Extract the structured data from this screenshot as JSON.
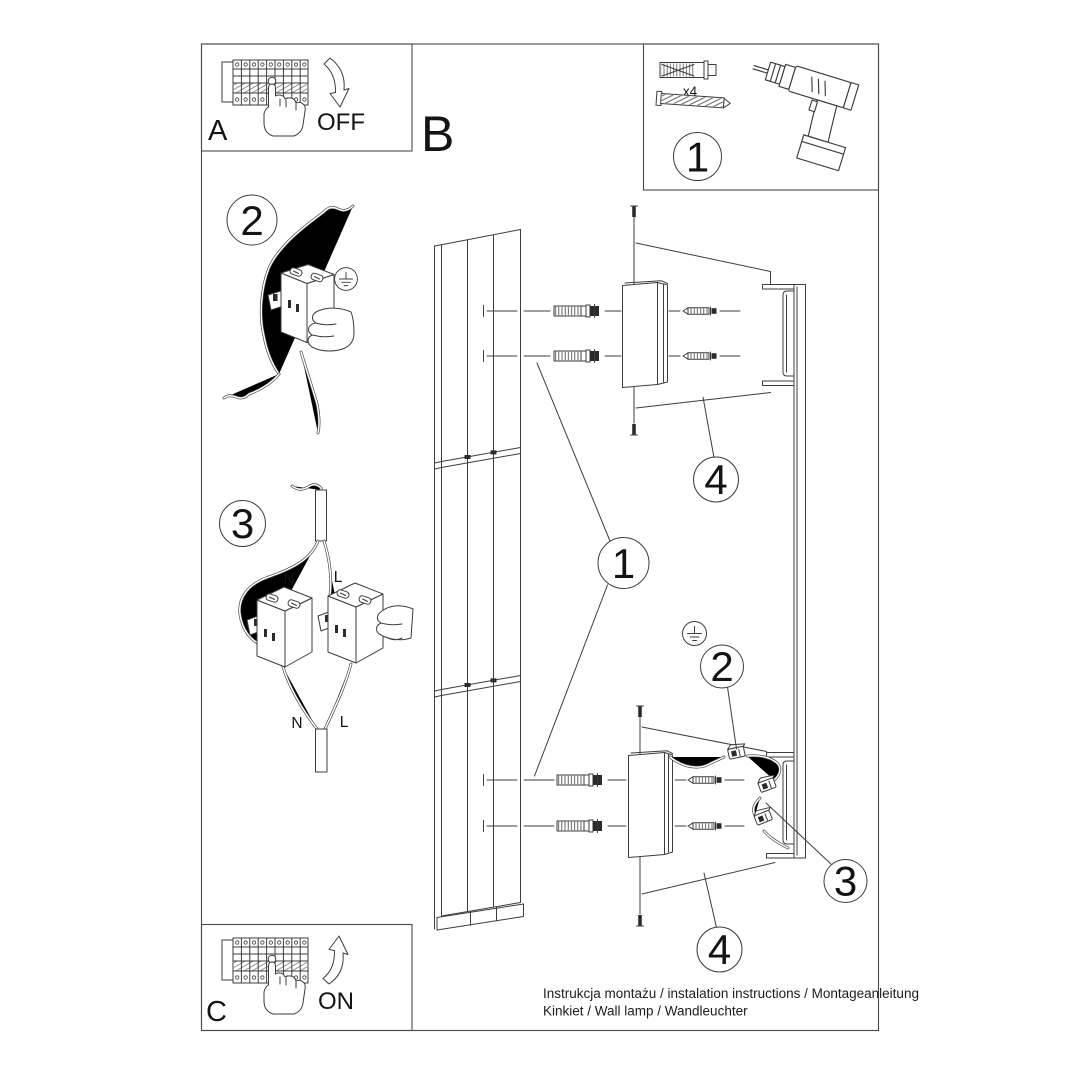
{
  "document": {
    "background": "#ffffff",
    "line_color": "#3d3d3d",
    "text_color": "#141414"
  },
  "steps": {
    "panel_a_label": "A",
    "panel_b_label": "B",
    "panel_c_label": "C",
    "power_off_label": "OFF",
    "power_on_label": "ON"
  },
  "toolbox": {
    "step_number": "1",
    "anchor_quantity_label": "x4"
  },
  "wiring_step_2": {
    "step_number": "2"
  },
  "wiring_step_3": {
    "step_number": "3",
    "top_neutral_label": "N",
    "top_live_label": "L",
    "bottom_neutral_label": "N",
    "bottom_live_label": "L"
  },
  "exploded_view": {
    "lamp_panel_callout": "1",
    "top_bracket_callout": "4",
    "bottom_bracket_callout": "4",
    "connector_callout": "2",
    "wiring_callout": "3"
  },
  "footer": {
    "line1": "Instrukcja montażu / instalation instructions / Montageanleitung",
    "line2": "Kinkiet / Wall lamp / Wandleuchter"
  }
}
